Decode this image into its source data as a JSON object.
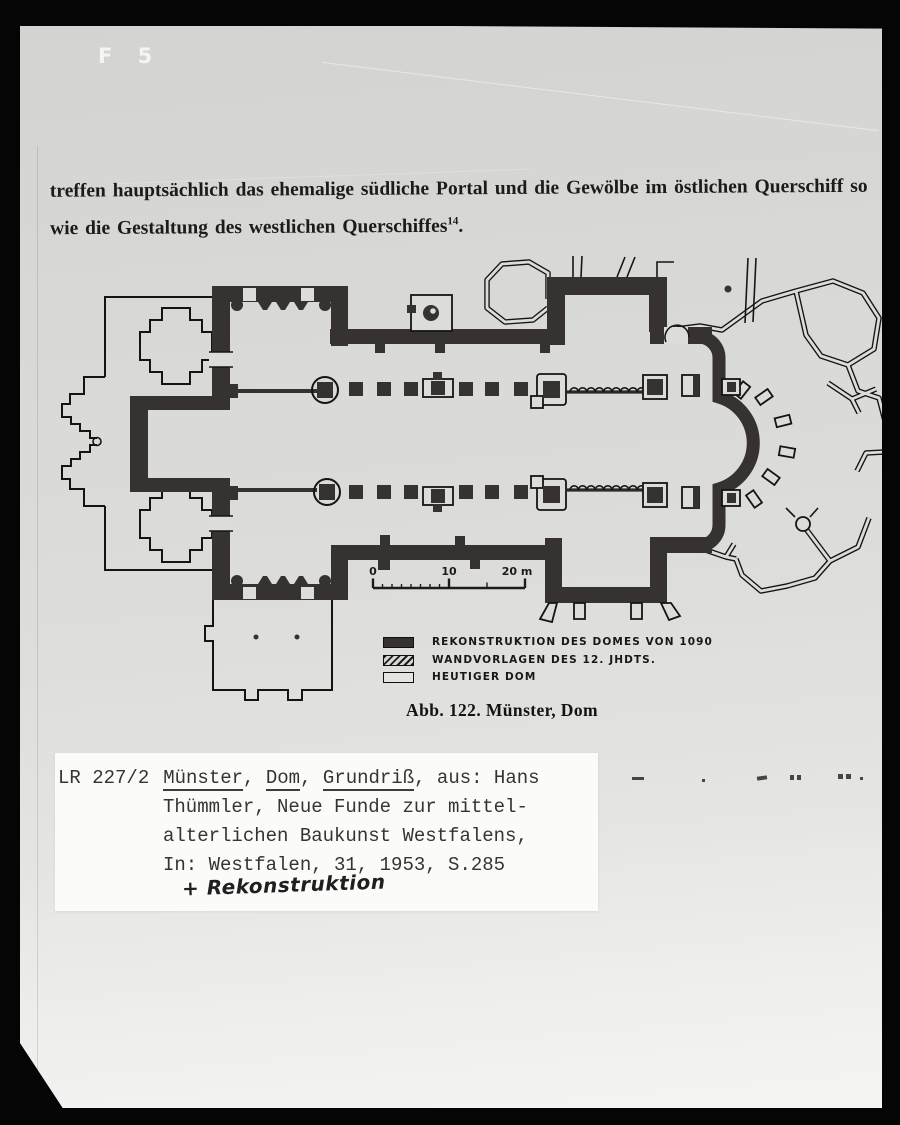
{
  "photo": {
    "corner_mark": "F 5"
  },
  "page": {
    "paragraph_line1": "treffen hauptsächlich das ehemalige südliche Portal und die Gewölbe im östlichen Querschiff so",
    "paragraph_line2": "wie die Gestaltung des westlichen Querschiffes",
    "footnote_ref": "14",
    "paragraph_line2_end": "."
  },
  "figure": {
    "caption": "Abb. 122. Münster, Dom",
    "scale_bar": {
      "start": "0",
      "mid": "10",
      "end": "20 m"
    },
    "legend": [
      {
        "swatch": "solid",
        "label": "REKONSTRUKTION DES DOMES VON 1090"
      },
      {
        "swatch": "hatched",
        "label": "WANDVORLAGEN DES 12. JHDTS."
      },
      {
        "swatch": "outline",
        "label": "HEUTIGER DOM"
      }
    ],
    "colors": {
      "reconstruction_wall": "#353230",
      "current_outline": "#141414",
      "paper": "#dcdcd9"
    }
  },
  "catalog_card": {
    "inventory_no": "LR 227/2",
    "title_word1": "Münster",
    "title_sep1": ", ",
    "title_word2": "Dom",
    "title_sep2": ", ",
    "title_word3": "Grundriß",
    "title_tail": ", aus: Hans",
    "line2": "Thümmler, Neue Funde zur mittel-",
    "line3": "alterlichen Baukunst Westfalens,",
    "line4": "In: Westfalen, 31, 1953, S.285",
    "handwritten_note": "+ Rekonstruktion"
  }
}
